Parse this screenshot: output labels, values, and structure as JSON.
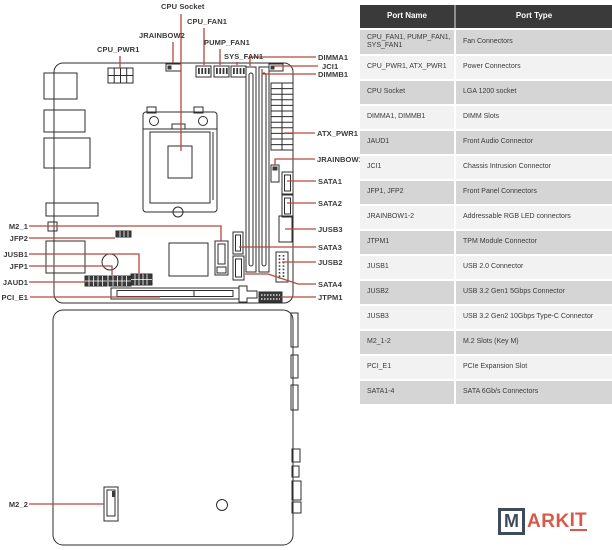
{
  "diagram": {
    "labels": {
      "cpu_socket": "CPU Socket",
      "cpu_fan1": "CPU_FAN1",
      "jrainbow2": "JRAINBOW2",
      "pump_fan1": "PUMP_FAN1",
      "cpu_pwr1": "CPU_PWR1",
      "sys_fan1": "SYS_FAN1",
      "dimma1": "DIMMA1",
      "jci1": "JCI1",
      "dimmb1": "DIMMB1",
      "atx_pwr1": "ATX_PWR1",
      "jrainbow1": "JRAINBOW1",
      "sata1": "SATA1",
      "sata2": "SATA2",
      "jusb3": "JUSB3",
      "sata3": "SATA3",
      "jusb2": "JUSB2",
      "sata4": "SATA4",
      "jtpm1": "JTPM1",
      "m2_1": "M2_1",
      "jfp2": "JFP2",
      "jusb1": "JUSB1",
      "jfp1": "JFP1",
      "jaud1": "JAUD1",
      "pci_e1": "PCI_E1",
      "m2_2": "M2_2"
    }
  },
  "table": {
    "headers": [
      "Port Name",
      "Port Type"
    ],
    "rows": [
      {
        "name": "CPU_FAN1, PUMP_FAN1, SYS_FAN1",
        "type": "Fan Connectors"
      },
      {
        "name": "CPU_PWR1, ATX_PWR1",
        "type": "Power Connectors"
      },
      {
        "name": "CPU Socket",
        "type": "LGA 1200 socket"
      },
      {
        "name": "DIMMA1, DIMMB1",
        "type": "DIMM Slots"
      },
      {
        "name": "JAUD1",
        "type": "Front Audio Connector"
      },
      {
        "name": "JCI1",
        "type": "Chassis Intrusion Connector"
      },
      {
        "name": "JFP1, JFP2",
        "type": "Front Panel Connectors"
      },
      {
        "name": "JRAINBOW1-2",
        "type": "Addressable RGB LED connectors"
      },
      {
        "name": "JTPM1",
        "type": "TPM Module Connector"
      },
      {
        "name": "JUSB1",
        "type": "USB 2.0 Connector"
      },
      {
        "name": "JUSB2",
        "type": "USB 3.2 Gen1 5Gbps Connector"
      },
      {
        "name": "JUSB3",
        "type": "USB 3.2 Gen2 10Gbps Type-C Connector"
      },
      {
        "name": "M2_1-2",
        "type": "M.2 Slots (Key M)"
      },
      {
        "name": "PCI_E1",
        "type": "PCIe Expansion Slot"
      },
      {
        "name": "SATA1-4",
        "type": "SATA 6Gb/s Connectors"
      }
    ]
  },
  "logo": {
    "m": "M",
    "ark": "ARK",
    "it": "IT"
  },
  "colors": {
    "callout_red": "#b5483c",
    "outline_dark": "#2c2c2c",
    "table_header_bg": "#3a3a3a",
    "table_row_gray": "#d5d5d5",
    "table_row_light": "#f2f2f2",
    "logo_navy": "#3e4b5c",
    "logo_red": "#d9584a"
  }
}
